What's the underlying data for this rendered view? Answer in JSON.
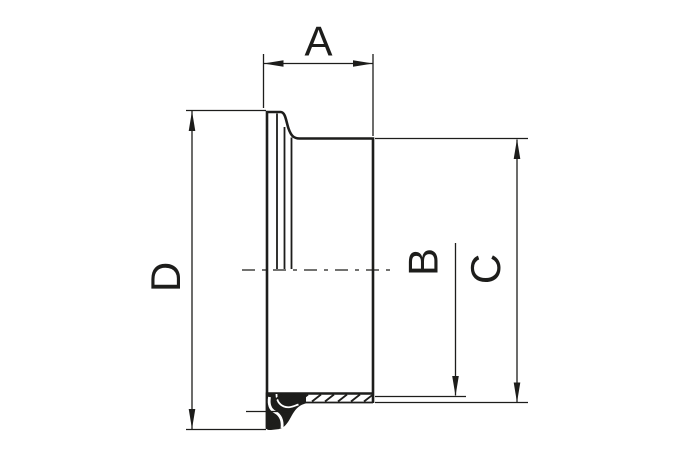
{
  "drawing": {
    "type": "technical-dimension-drawing",
    "subject": "clamp-ferrule-half-section",
    "colors": {
      "line": "#1d1d1b",
      "background": "#ffffff"
    },
    "dimensions": [
      {
        "label": "A",
        "orientation": "horizontal",
        "position": "top"
      },
      {
        "label": "B",
        "orientation": "vertical",
        "position": "inner-right"
      },
      {
        "label": "C",
        "orientation": "vertical",
        "position": "outer-right"
      },
      {
        "label": "D",
        "orientation": "vertical",
        "position": "left"
      }
    ]
  }
}
